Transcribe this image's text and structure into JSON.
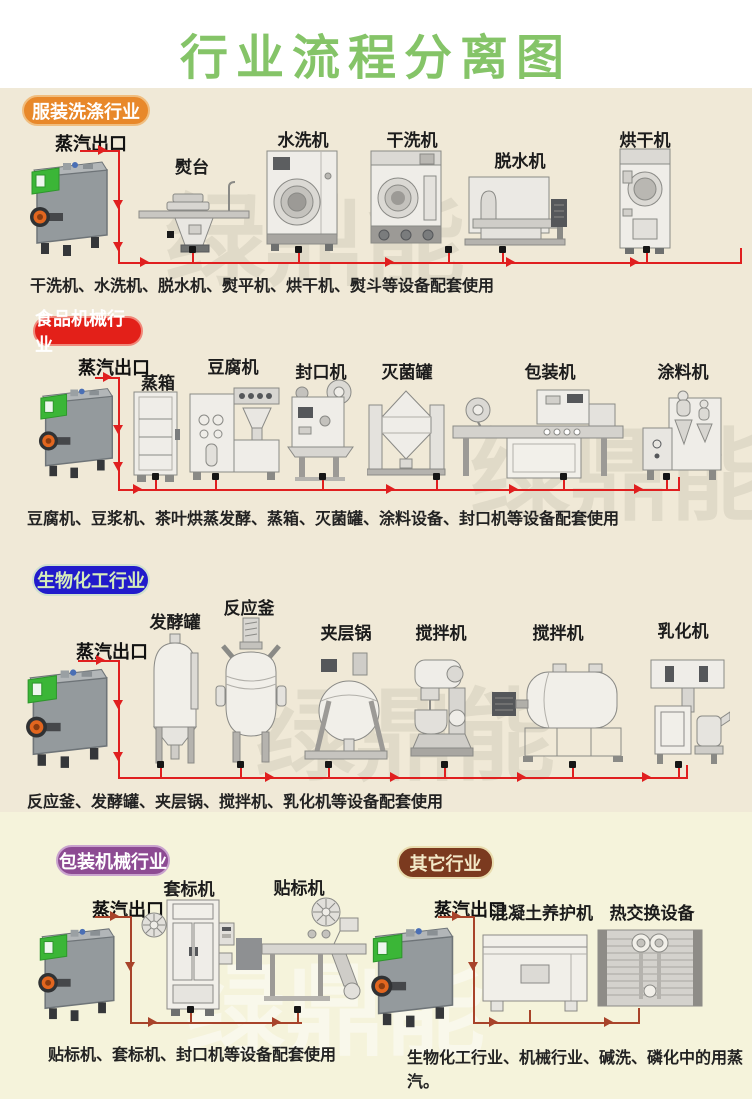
{
  "title": "行业流程分离图",
  "watermark": "绿鼎能",
  "steam_outlet_label": "蒸汽出口",
  "sections": [
    {
      "badge": "服装洗涤行业",
      "badge_color": "#e8882a",
      "machines": [
        {
          "label": "熨台"
        },
        {
          "label": "水洗机"
        },
        {
          "label": "干洗机"
        },
        {
          "label": "脱水机"
        },
        {
          "label": "烘干机"
        }
      ],
      "caption": "干洗机、水洗机、脱水机、熨平机、烘干机、熨斗等设备配套使用"
    },
    {
      "badge": "食品机械行业",
      "badge_color": "#e32019",
      "machines": [
        {
          "label": "蒸箱"
        },
        {
          "label": "豆腐机"
        },
        {
          "label": "封口机"
        },
        {
          "label": "灭菌罐"
        },
        {
          "label": "包装机"
        },
        {
          "label": "涂料机"
        }
      ],
      "caption": "豆腐机、豆浆机、茶叶烘蒸发酵、蒸箱、灭菌罐、涂料设备、封口机等设备配套使用"
    },
    {
      "badge": "生物化工行业",
      "badge_color": "#211bcb",
      "machines": [
        {
          "label": "发酵罐"
        },
        {
          "label": "反应釜"
        },
        {
          "label": "夹层锅"
        },
        {
          "label": "搅拌机"
        },
        {
          "label": "搅拌机"
        },
        {
          "label": "乳化机"
        }
      ],
      "caption": "反应釜、发酵罐、夹层锅、搅拌机、乳化机等设备配套使用"
    },
    {
      "badge": "包装机械行业",
      "badge_color": "#8d4b93",
      "machines": [
        {
          "label": "套标机"
        },
        {
          "label": "贴标机"
        }
      ],
      "caption": "贴标机、套标机、封口机等设备配套使用"
    },
    {
      "badge": "其它行业",
      "badge_color": "#7b3a1f",
      "machines": [
        {
          "label": "混凝土养护机"
        },
        {
          "label": "热交换设备"
        }
      ],
      "caption": "生物化工行业、机械行业、碱洗、磷化中的用蒸汽。"
    }
  ],
  "colors": {
    "title_green": "#85c468",
    "pipe_red": "#e01f1f",
    "pipe_dark_red": "#a8432a",
    "bg_upper": "#f0e9d7",
    "bg_lower": "#f5f3db",
    "generator_green": "#3bb637",
    "burner_orange": "#e2661f"
  }
}
